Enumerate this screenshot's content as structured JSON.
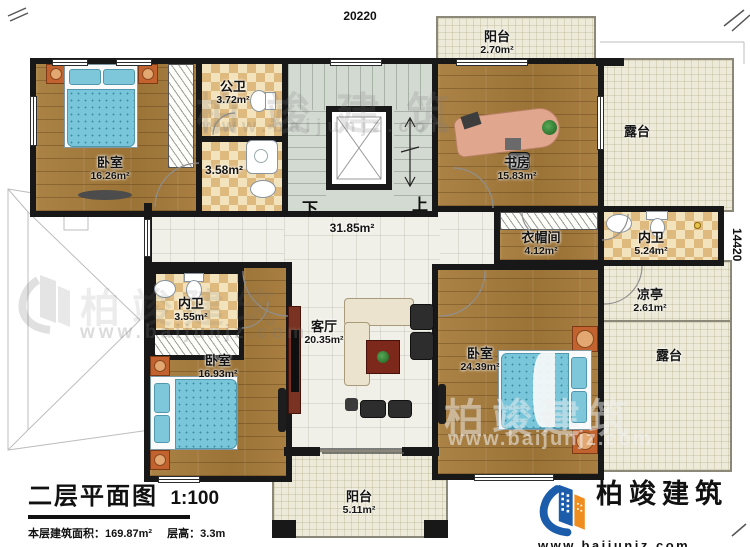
{
  "plan_title": {
    "main": "二层平面图",
    "scale": "1:100",
    "area_label": "本层建筑面积：",
    "area_value": "169.87m²",
    "height_label": "层高：",
    "height_value": "3.3m"
  },
  "dimensions": {
    "top_width": "20220",
    "right_height": "14420"
  },
  "stairs": {
    "down": "下",
    "up": "上"
  },
  "rooms": {
    "bedroom_tl": {
      "name": "卧室",
      "area": "16.26m²"
    },
    "bath_public": {
      "name": "公卫",
      "area": "3.72m²"
    },
    "bath_shower": {
      "area": "3.58m²"
    },
    "study": {
      "name": "书房",
      "area": "15.83m²"
    },
    "balcony_top": {
      "name": "阳台",
      "area": "2.70m²"
    },
    "terrace_top_right": {
      "name": "露台"
    },
    "closet": {
      "name": "衣帽间",
      "area": "4.12m²"
    },
    "bath_right": {
      "name": "内卫",
      "area": "5.24m²"
    },
    "pavilion": {
      "name": "凉亭",
      "area": "2.61m²"
    },
    "terrace_right": {
      "name": "露台"
    },
    "bath_left": {
      "name": "内卫",
      "area": "3.55m²"
    },
    "bedroom_bl": {
      "name": "卧室",
      "area": "16.93m²"
    },
    "living": {
      "name": "客厅",
      "area": "20.35m²"
    },
    "bedroom_br": {
      "name": "卧室",
      "area": "24.39m²"
    },
    "balcony_bottom": {
      "name": "阳台",
      "area": "5.11m²"
    },
    "hall": {
      "area": "31.85m²"
    }
  },
  "brand": {
    "name": "柏竣建筑",
    "url": "www.baijunjz.com"
  },
  "watermark": {
    "text": "柏竣建筑",
    "url": "www.baijunjz.com"
  },
  "colors": {
    "wall": "#181818",
    "wood": "#a57c3e",
    "tile_check": "#dfba7e",
    "terrace": "#edead9",
    "stair": "#d3dad1",
    "brand_blue": "#1b5cab",
    "brand_orange": "#ef8d1f",
    "bed_blue": "#79c6da",
    "nightstand_orange": "#c2622e"
  }
}
